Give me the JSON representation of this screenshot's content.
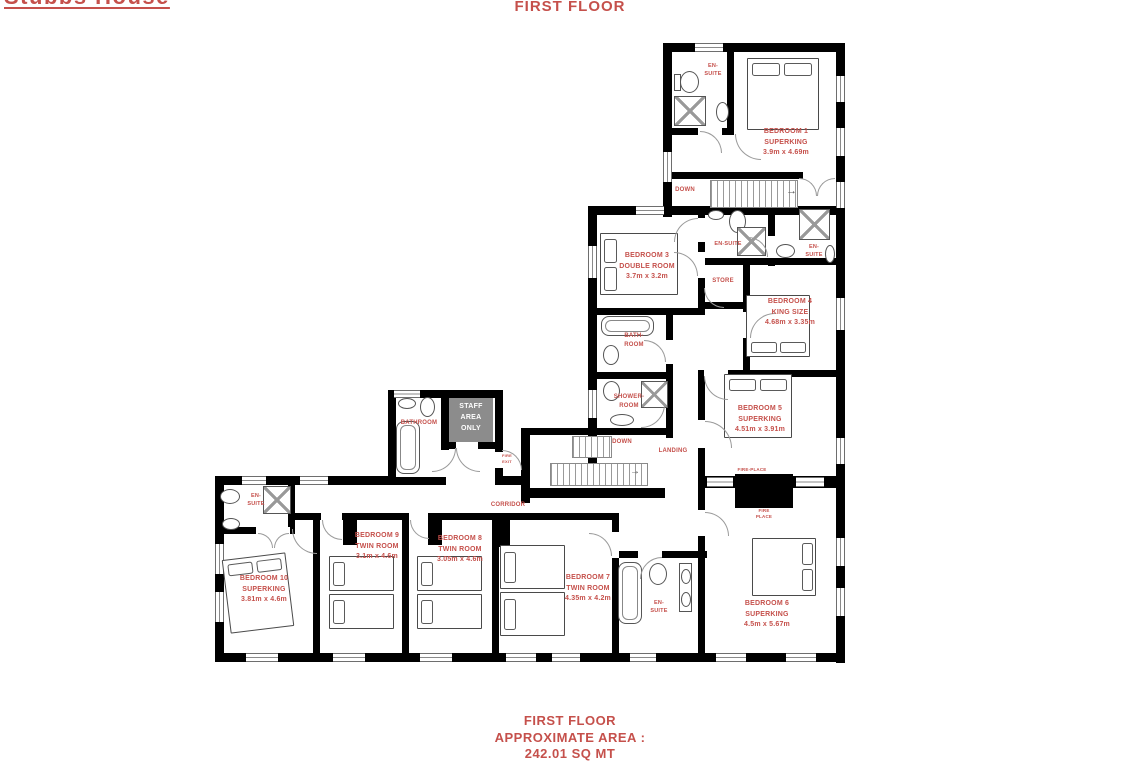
{
  "header": {
    "property_name": "Stubbs House",
    "floor_title": "FIRST FLOOR"
  },
  "footer": {
    "line1": "FIRST FLOOR",
    "line2": "APPROXIMATE AREA :",
    "line3": "242.01 SQ MT"
  },
  "colors": {
    "label_red": "#c5504b",
    "wall_black": "#000000",
    "staff_area_gray": "#8c8c8c",
    "staff_text": "#ffffff"
  },
  "symbols": {
    "stair_arrow": "→",
    "shower": "x-cross-square",
    "door": "quarter-arc",
    "window": "double-line-gap",
    "stairs": "striped-treads"
  },
  "rooms": {
    "bedroom1": {
      "name": "BEDROOM 1",
      "type": "SUPERKING",
      "dims": "3.9m x 4.69m"
    },
    "ensuite1": {
      "l1": "EN-",
      "l2": "SUITE"
    },
    "down_top": {
      "label": "DOWN"
    },
    "bedroom3": {
      "name": "BEDROOM 3",
      "type": "DOUBLE ROOM",
      "dims": "3.7m x 3.2m"
    },
    "ensuite3": {
      "label": "EN-SUITE"
    },
    "ensuite4": {
      "l1": "EN-",
      "l2": "SUITE"
    },
    "store": {
      "label": "STORE"
    },
    "bedroom4": {
      "name": "BEDROOM 4",
      "type": "KING SIZE",
      "dims": "4.68m x 3.35m"
    },
    "bathroom_main": {
      "l1": "BATH-",
      "l2": "ROOM"
    },
    "shower_room": {
      "l1": "SHOWER-",
      "l2": "ROOM"
    },
    "down_mid": {
      "label": "DOWN"
    },
    "landing": {
      "label": "LANDING"
    },
    "bedroom5": {
      "name": "BEDROOM 5",
      "type": "SUPERKING",
      "dims": "4.51m x 3.91m"
    },
    "fireplace5": {
      "label": "FIRE-PLACE"
    },
    "fireplace6": {
      "l1": "FIRE",
      "l2": "PLACE"
    },
    "staff_bathroom": {
      "label": "BATHROOM"
    },
    "staff_area": {
      "l1": "STAFF",
      "l2": "AREA",
      "l3": "ONLY"
    },
    "fire_exit": {
      "l1": "FIRE",
      "l2": "EXIT"
    },
    "corridor": {
      "label": "CORRIDOR"
    },
    "ensuite10": {
      "l1": "EN-",
      "l2": "SUITE"
    },
    "bedroom10": {
      "name": "BEDROOM 10",
      "type": "SUPERKING",
      "dims": "3.81m x 4.6m"
    },
    "bedroom9": {
      "name": "BEDROOM 9",
      "type": "TWIN ROOM",
      "dims": "3.1m x 4.6m"
    },
    "bedroom8": {
      "name": "BEDROOM 8",
      "type": "TWIN ROOM",
      "dims": "3.05m x 4.6m"
    },
    "bedroom7": {
      "name": "BEDROOM 7",
      "type": "TWIN ROOM",
      "dims": "4.35m x 4.2m"
    },
    "ensuite7": {
      "l1": "EN-",
      "l2": "SUITE"
    },
    "bedroom6": {
      "name": "BEDROOM 6",
      "type": "SUPERKING",
      "dims": "4.5m x 5.67m"
    }
  }
}
